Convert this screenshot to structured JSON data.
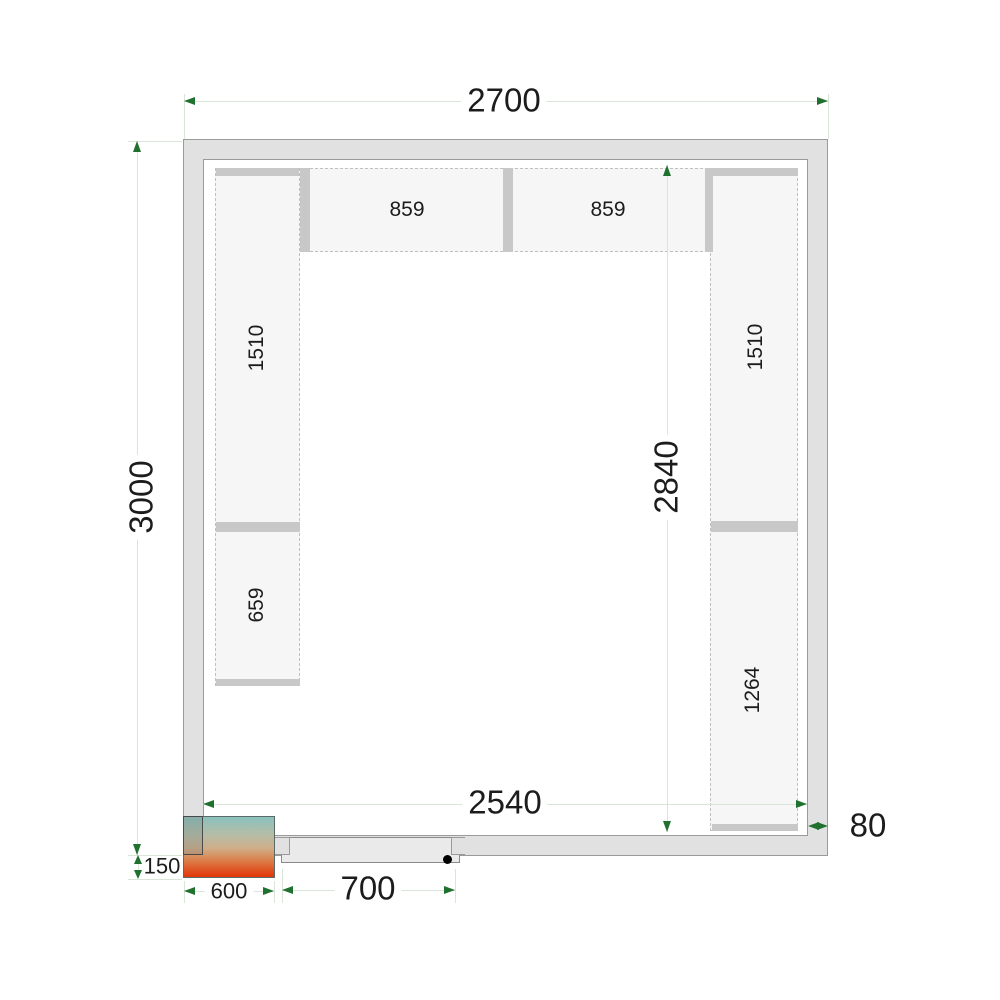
{
  "dims": {
    "outer_width": "2700",
    "outer_height": "3000",
    "inner_width": "2540",
    "inner_height": "2840",
    "wall_thickness": "80",
    "door_opening": "700",
    "unit_width": "600",
    "unit_offset": "150"
  },
  "shelves": {
    "top_left": "859",
    "top_right": "859",
    "left_upper": "1510",
    "left_lower": "659",
    "right_upper": "1510",
    "right_lower": "1264"
  },
  "colors": {
    "accent_green": "#20702f",
    "dim_line": "#d9e5d9",
    "text": "#1c1c1c",
    "wall_fill": "#e1e1e1",
    "wall_border": "#9a9a9a",
    "shelf_fill": "#f6f6f6",
    "shelf_dash": "#c0c0c0",
    "bar_fill": "#c8c8c8",
    "door_fill": "#eaeaea",
    "gradient_top": "#8bc1bd",
    "gradient_mid": "#cfae89",
    "gradient_bottom": "#e23c0e"
  }
}
